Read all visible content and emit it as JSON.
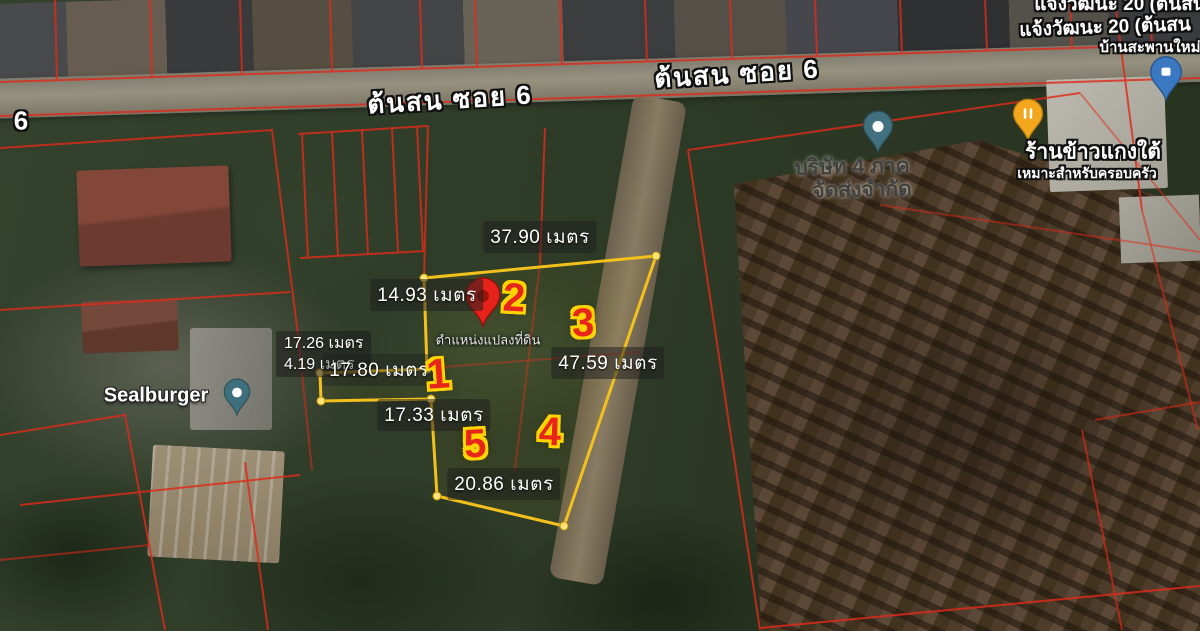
{
  "road": {
    "label_left": "ต้นสน ซอย 6",
    "label_right": "ต้นสน ซอย 6",
    "edge_number": "6"
  },
  "plot": {
    "caption": "ตำแหน่งแปลงที่ดิน",
    "measurements": {
      "top": "37.90 เมตร",
      "upper_left": "14.93 เมตร",
      "right": "47.59 เมตร",
      "side_a": "17.26 เมตร",
      "side_b": "4.19 เมตร",
      "arm": "17.80 เมตร",
      "middle": "17.33 เมตร",
      "bottom": "20.86 เมตร"
    },
    "markers": {
      "m1": "1",
      "m2": "2",
      "m3": "3",
      "m4": "4",
      "m5": "5"
    },
    "colors": {
      "boundary": "#f2c11d",
      "marker_fill": "#e8251a",
      "marker_outline": "#ffd400",
      "location_pin": "#e5231b",
      "cadastral_line": "#dd2b1b"
    }
  },
  "pois": {
    "sealburger": {
      "label": "Sealburger"
    },
    "company": {
      "line1": "บริษัท 4 ภาค",
      "line2": "จัดส่งจำกัด"
    },
    "restaurant": {
      "line1": "ร้านข้าวแกงใต้",
      "line2": "เหมาะสำหรับครอบครัว"
    },
    "top_right": {
      "line1": "แจ้งวัฒนะ 20 (ต้นสน",
      "line2": "แจ้งวัฒนะ 20 (ต้นสน",
      "line3": "บ้านสะพานใหม่"
    }
  }
}
